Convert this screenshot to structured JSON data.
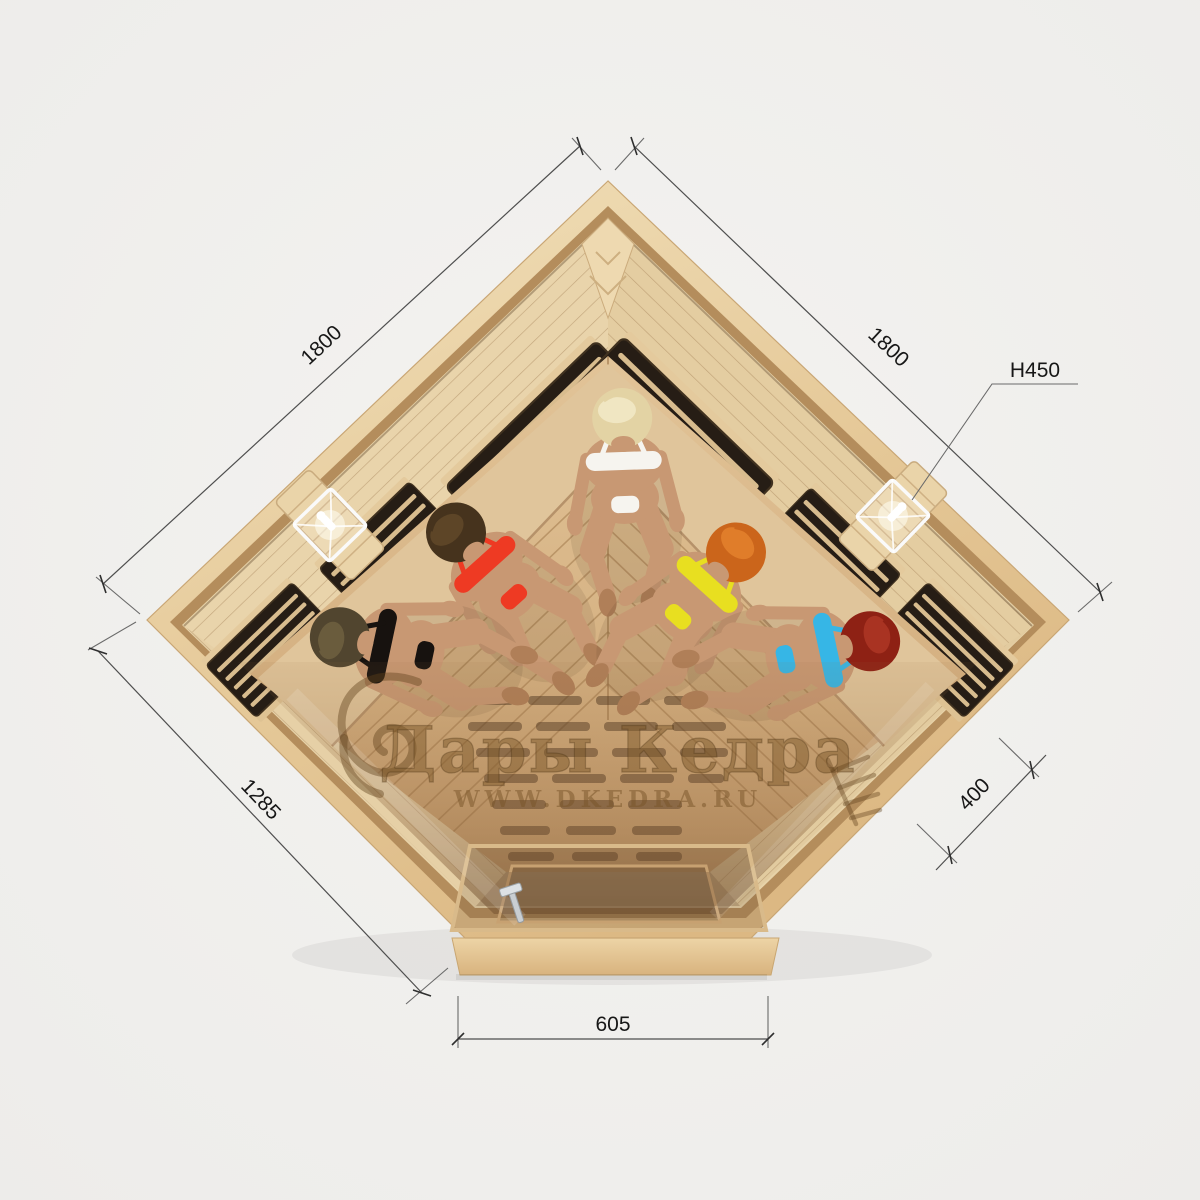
{
  "scene": {
    "description": "Top view render of a corner infrared sauna cabin with five women seated inside on benches",
    "background_color": "#f1f0ee"
  },
  "watermark": {
    "title": "Дары Кедра",
    "url": "WWW.DKEDRA.RU",
    "color": "#7d5a2a"
  },
  "dimensions": {
    "left_back_wall": "1800",
    "right_back_wall": "1800",
    "height_label": "H450",
    "front_left_wall": "1285",
    "corner_depth": "400",
    "front_door_width": "605"
  },
  "people": [
    {
      "position": "left-corner",
      "hair": "#51452f",
      "hair2": "#6a5c3d",
      "suit": "#17120f"
    },
    {
      "position": "back-left",
      "hair": "#46331d",
      "hair2": "#5d4527",
      "suit": "#ee3a23"
    },
    {
      "position": "back-center",
      "hair": "#e3d3a4",
      "hair2": "#f0e6c2",
      "suit": "#f6f4ef"
    },
    {
      "position": "back-right",
      "hair": "#cb651b",
      "hair2": "#e07d2a",
      "suit": "#e8df20"
    },
    {
      "position": "right-corner",
      "hair": "#8e2114",
      "hair2": "#a93322",
      "suit": "#36b6e6"
    }
  ],
  "fixtures": {
    "wall_lamps": 2,
    "infrared_heater_panels": 6,
    "door_handle": 1
  },
  "colors": {
    "wood_rim_light": "#f2e2bd",
    "wood_rim_dark": "#d9b584",
    "wall_panel": "#e7d2a8",
    "heater_dark": "#261d15",
    "heater_slat": "#d8bc8e",
    "floor": "#d9b88c",
    "glass_tint": "#8a6240",
    "skin": "#c89873"
  }
}
